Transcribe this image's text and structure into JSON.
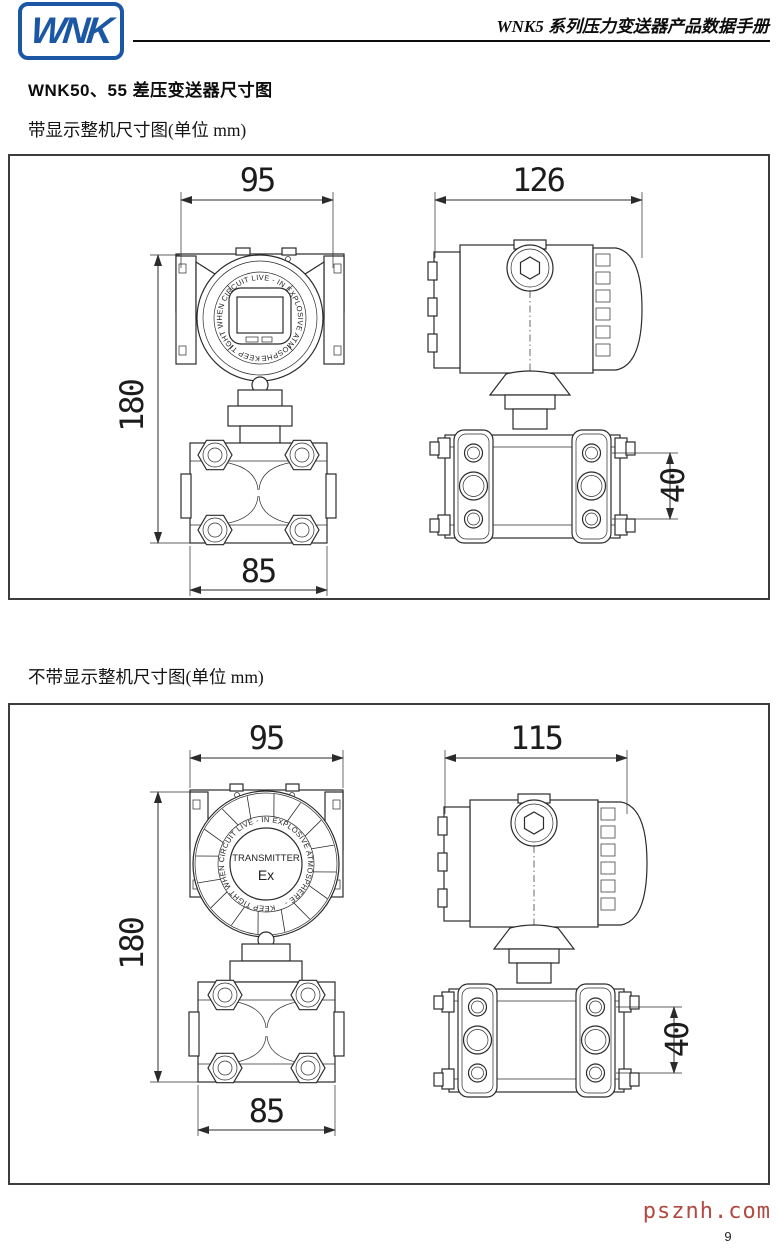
{
  "header": {
    "logo_text": "WNK",
    "title": "WNK5 系列压力变送器产品数据手册"
  },
  "section": {
    "title": "WNK50、55 差压变送器尺寸图"
  },
  "figure1": {
    "caption": "带显示整机尺寸图(单位 mm)",
    "front": {
      "dim_top": "95",
      "dim_left": "180",
      "dim_bottom": "85",
      "bezel_text": "KEEP TIGHT WHEN CIRCUIT LIVE - IN EXPLOSIVE ATMOSPHERE -"
    },
    "side": {
      "dim_top": "126",
      "dim_right": "40"
    }
  },
  "figure2": {
    "caption": "不带显示整机尺寸图(单位 mm)",
    "front": {
      "dim_top": "95",
      "dim_left": "180",
      "dim_bottom": "85",
      "cover_title": "TRANSMITTER",
      "cover_mark": "Ex",
      "bezel_text": "KEEP TIGHT WHEN CIRCUIT LIVE - IN EXPLOSIVE ATMOSPHERE -"
    },
    "side": {
      "dim_top": "115",
      "dim_right": "40"
    }
  },
  "footer": {
    "watermark": "psznh.com",
    "page_number": "9"
  },
  "colors": {
    "logo_blue": "#1b57a5",
    "watermark_red": "#b04a42",
    "line_color": "#2b2b2b"
  }
}
